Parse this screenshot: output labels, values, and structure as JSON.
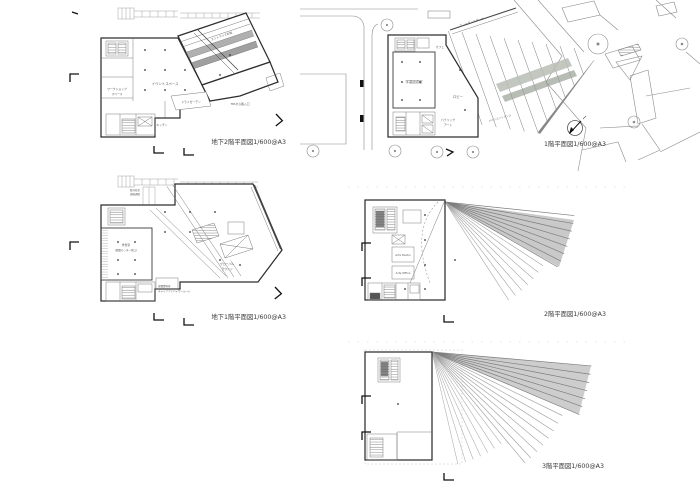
{
  "sheet": {
    "background": "#ffffff",
    "ink": "#3a3a3a",
    "light_ink": "#9a9a9a",
    "slat_fill": "#9c9c9c",
    "band_fill": "#b7bdb4"
  },
  "plans": {
    "b2": {
      "caption": "地下2階平面図1/600@A3",
      "labels": {
        "entrance_void": "エントランス吹抜",
        "event_space": "イベントスペース",
        "workshop_line1": "ワークショップ",
        "workshop_line2": "スペース",
        "dry_garden": "ドライガーデン",
        "tpa_dock": "TPAから搬入口",
        "kitchen": "キッチン"
      }
    },
    "b1": {
      "caption": "地下1階平面図1/600@A3",
      "labels": {
        "bridge_line1": "既存校舎",
        "bridge_line2": "連絡通路",
        "study_line1": "学習室",
        "study_line2": "(図書センター窓口)",
        "lounge_line1": "グローバル",
        "lounge_line2": "ラウンジ",
        "career_line1": "就職資料室",
        "career_line2": "キャリアアドバイザールーム"
      }
    },
    "f1": {
      "caption": "1階平面図1/600@A3",
      "labels": {
        "porch": "エントランスポーチ",
        "cafe": "カフェ",
        "library": "学習図書室",
        "lobby": "ロビー",
        "public_art_line1": "パブリック",
        "public_art_line2": "アート",
        "main_entrance": "メインエントランス"
      }
    },
    "f2": {
      "caption": "2階平面図1/600@A3",
      "labels": {
        "arts_studio": "Arts Studio",
        "arts_office": "Arts Office"
      }
    },
    "f3": {
      "caption": "3階平面図1/600@A3"
    }
  }
}
